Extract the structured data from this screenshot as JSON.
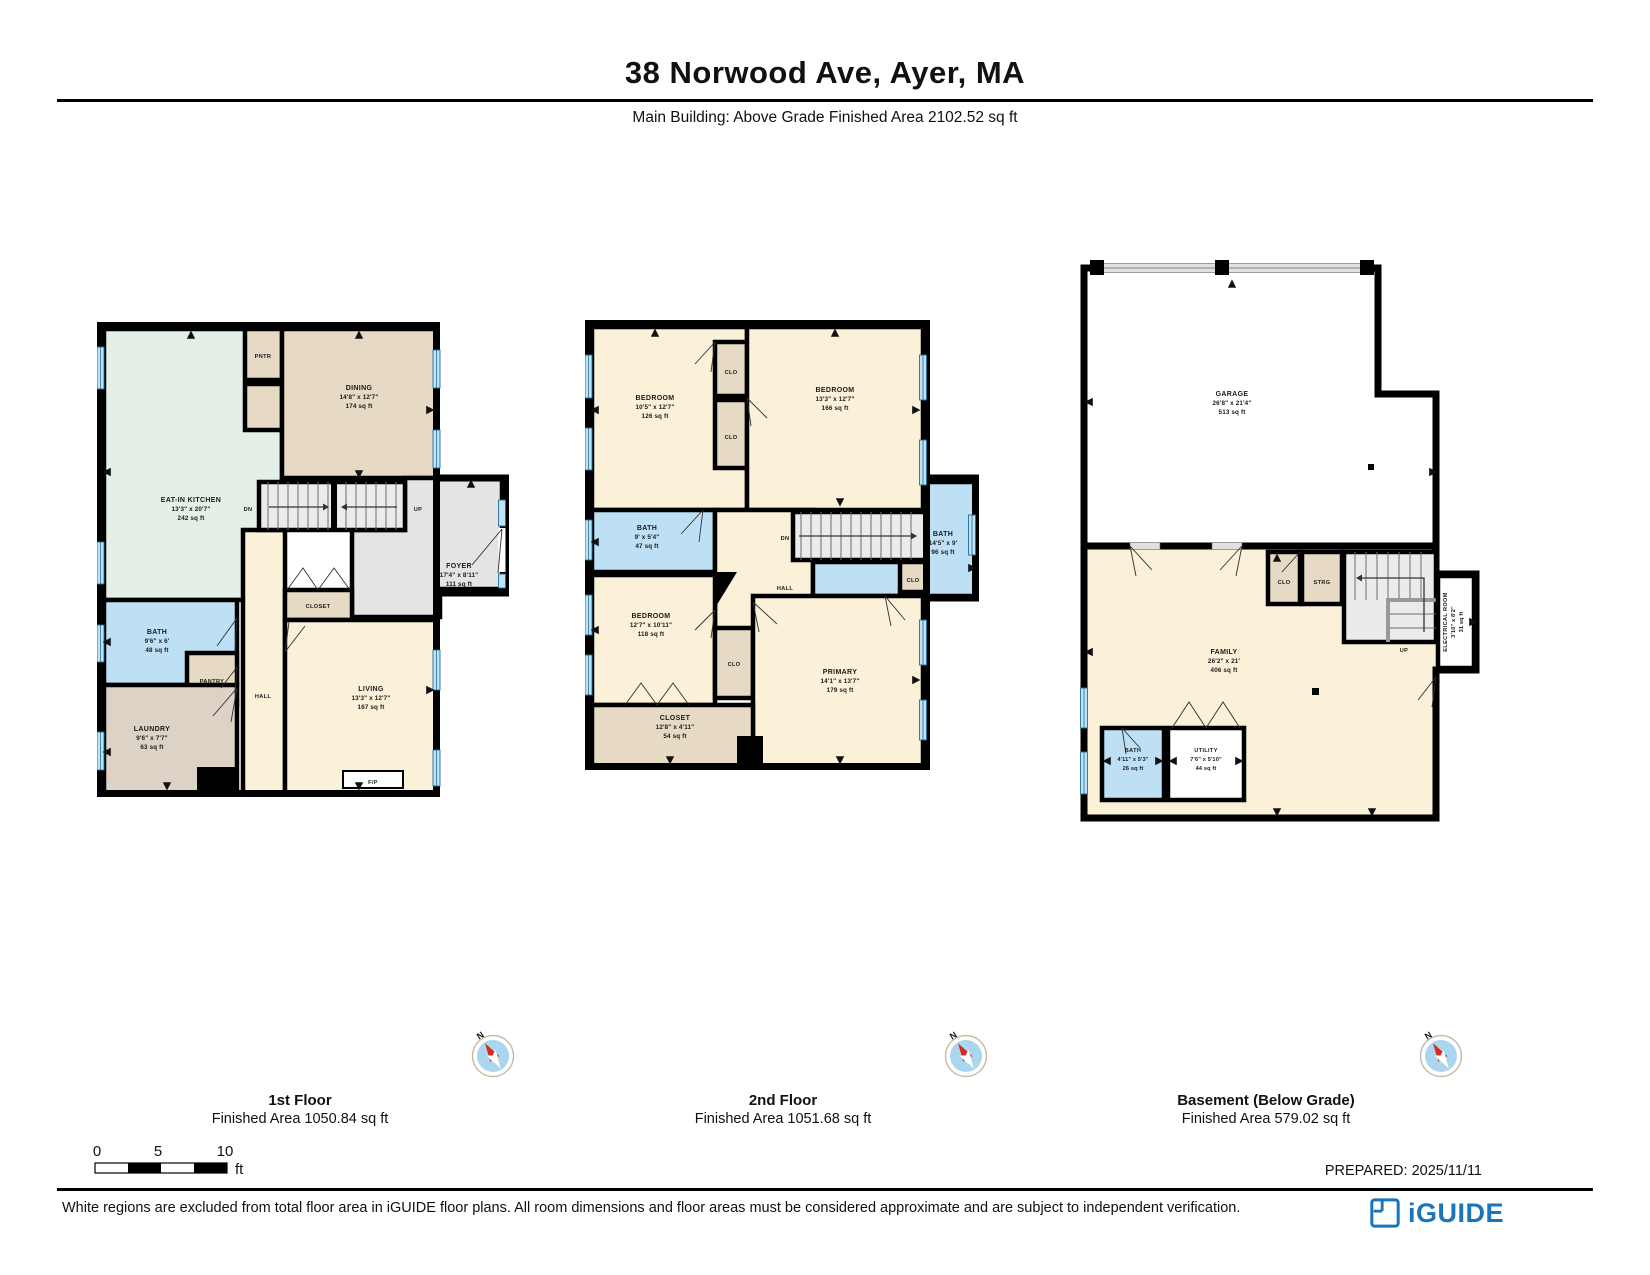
{
  "header": {
    "title": "38 Norwood Ave, Ayer, MA",
    "subtitle": "Main Building: Above Grade Finished Area 2102.52 sq ft"
  },
  "floor1": {
    "label": "1st Floor",
    "area": "Finished Area 1050.84 sq ft",
    "rooms": {
      "kitchen": {
        "name": "EAT-IN KITCHEN",
        "dims": "13'3\" x 20'7\"",
        "area": "242 sq ft"
      },
      "pntr": {
        "name": "PNTR"
      },
      "dining": {
        "name": "DINING",
        "dims": "14'8\" x 12'7\"",
        "area": "174 sq ft"
      },
      "foyer": {
        "name": "FOYER",
        "dims": "17'4\" x 8'11\"",
        "area": "111 sq ft"
      },
      "closet": {
        "name": "CLOSET"
      },
      "bath": {
        "name": "BATH",
        "dims": "9'6\" x 6'",
        "area": "48 sq ft"
      },
      "pantry": {
        "name": "PANTRY"
      },
      "hall": {
        "name": "HALL"
      },
      "laundry": {
        "name": "LAUNDRY",
        "dims": "9'6\" x 7'7\"",
        "area": "63 sq ft"
      },
      "living": {
        "name": "LIVING",
        "dims": "13'3\" x 12'7\"",
        "area": "167 sq ft"
      },
      "fireplace": {
        "name": "F/P"
      },
      "stairs_down": "DN",
      "stairs_up": "UP"
    }
  },
  "floor2": {
    "label": "2nd Floor",
    "area": "Finished Area 1051.68 sq ft",
    "rooms": {
      "bedroom_nw": {
        "name": "BEDROOM",
        "dims": "10'5\" x 12'7\"",
        "area": "126 sq ft"
      },
      "clo_upper": {
        "name": "CLO"
      },
      "clo_lower": {
        "name": "CLO"
      },
      "bedroom_ne": {
        "name": "BEDROOM",
        "dims": "13'3\" x 12'7\"",
        "area": "166 sq ft"
      },
      "bath_w": {
        "name": "BATH",
        "dims": "9' x 5'4\"",
        "area": "47 sq ft"
      },
      "hall": {
        "name": "HALL"
      },
      "stairs_down": "DN",
      "clo_stairs": {
        "name": "CLO"
      },
      "bath_e": {
        "name": "BATH",
        "dims": "14'5\" x 9'",
        "area": "96 sq ft"
      },
      "bedroom_sw": {
        "name": "BEDROOM",
        "dims": "12'7\" x 10'11\"",
        "area": "118 sq ft"
      },
      "clo_mid": {
        "name": "CLO"
      },
      "primary": {
        "name": "PRIMARY",
        "dims": "14'1\" x 13'7\"",
        "area": "179 sq ft"
      },
      "closet_s": {
        "name": "CLOSET",
        "dims": "12'8\" x 4'11\"",
        "area": "54 sq ft"
      }
    }
  },
  "floor3": {
    "label": "Basement (Below Grade)",
    "area": "Finished Area 579.02 sq ft",
    "rooms": {
      "garage": {
        "name": "GARAGE",
        "dims": "26'8\" x 21'4\"",
        "area": "513 sq ft"
      },
      "family": {
        "name": "FAMILY",
        "dims": "26'2\" x 21'",
        "area": "406 sq ft"
      },
      "clo": {
        "name": "CLO"
      },
      "strg": {
        "name": "STRG"
      },
      "stairs_up": "UP",
      "electrical": {
        "name": "ELECTRICAL ROOM",
        "dims": "3'10\" x 8'2\"",
        "area": "31 sq ft"
      },
      "bath": {
        "name": "BATH",
        "dims": "4'11\" x 5'3\"",
        "area": "26 sq ft"
      },
      "utility": {
        "name": "UTILITY",
        "dims": "7'6\" x 5'10\"",
        "area": "44 sq ft"
      }
    }
  },
  "compass": {
    "label": "N"
  },
  "scale_bar": {
    "t0": "0",
    "t5": "5",
    "t10": "10",
    "unit": "ft"
  },
  "footer": {
    "prepared": "PREPARED: 2025/11/11",
    "disclaimer": "White regions are excluded from total floor area in iGUIDE floor plans. All room dimensions and floor areas must be considered approximate and are subject to independent verification.",
    "brand": "iGUIDE"
  },
  "palette": {
    "bath_blue": "#BDE0F5",
    "room_cream": "#FAF1D8",
    "room_tan": "#E6DAC5",
    "kitchen_mint": "#E4EFE8",
    "foyer_gray": "#E4E4E4",
    "wall": "#000000",
    "window_blue": "#20719C",
    "brand_blue": "#1B75BB",
    "compass_red": "#D8291C"
  }
}
